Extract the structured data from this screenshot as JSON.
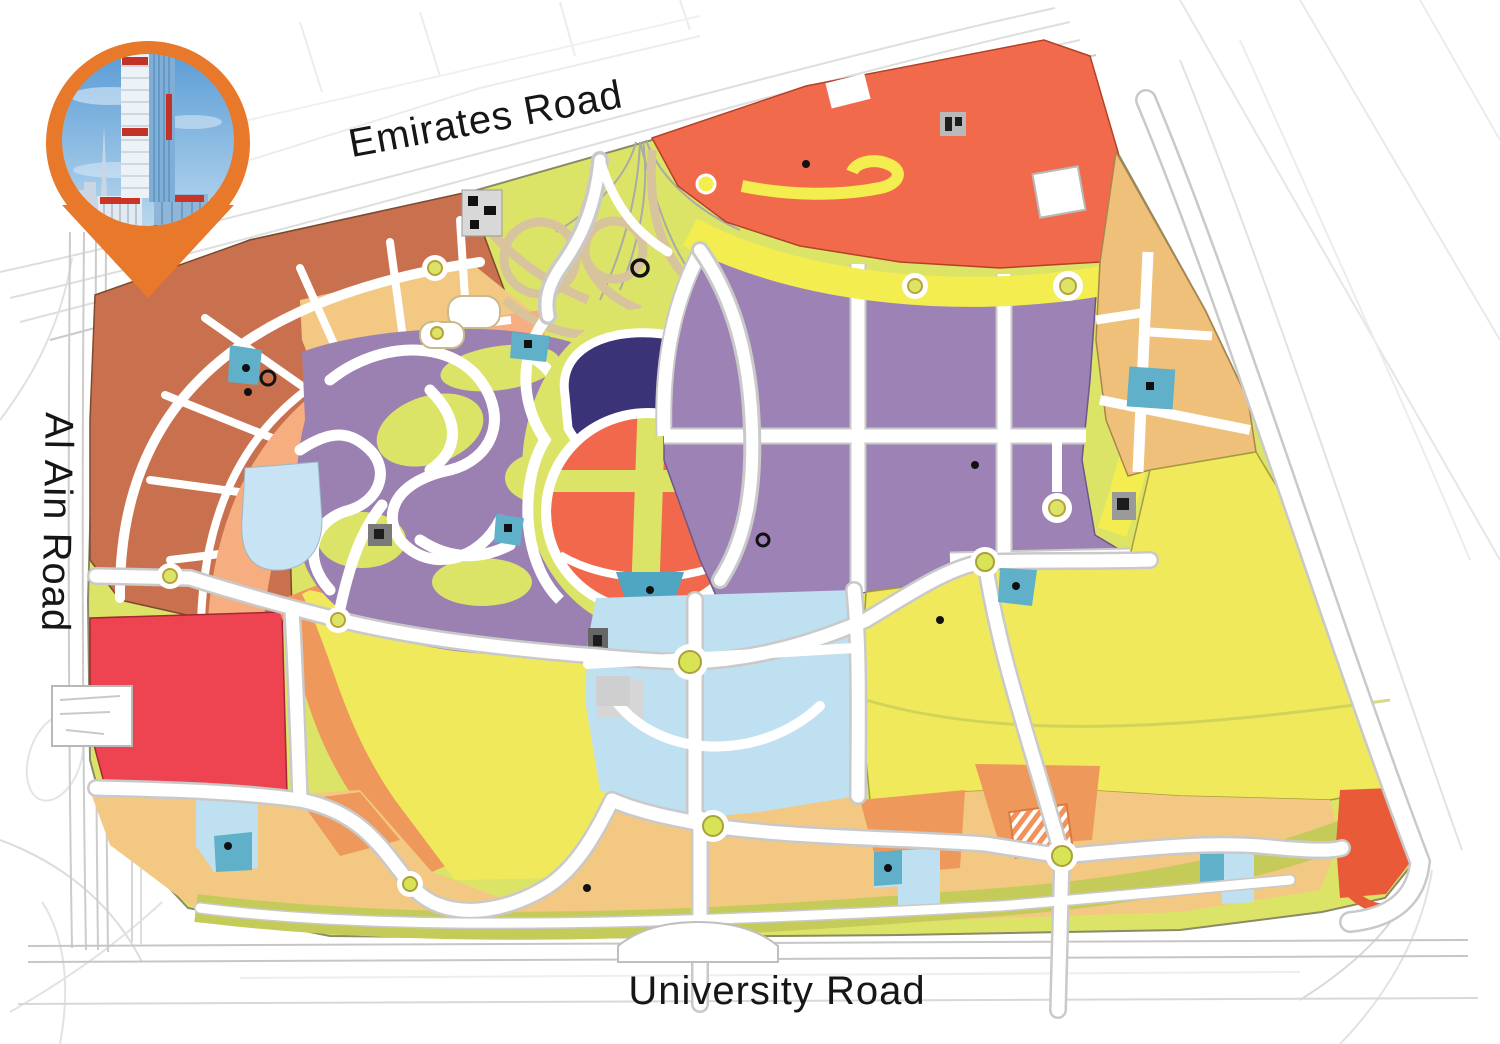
{
  "map": {
    "type": "master-plan-map",
    "labels": {
      "top_road": "Emirates Road",
      "left_road": "Al Ain Road",
      "bottom_road": "University Road"
    },
    "regions": [
      {
        "name": "terracotta-residential-northwest",
        "color": "#C9714E"
      },
      {
        "name": "salmon-residential-arc",
        "color": "#F6AD7F"
      },
      {
        "name": "tan-residential",
        "color": "#F2C883"
      },
      {
        "name": "orange-mixed-use",
        "color": "#EF985B"
      },
      {
        "name": "red-plot-west",
        "color": "#EE4350"
      },
      {
        "name": "orange-red-strip-north",
        "color": "#F26A4C"
      },
      {
        "name": "central-oval-orange",
        "color": "#F2684C"
      },
      {
        "name": "bright-yellow-band",
        "color": "#F4ED50"
      },
      {
        "name": "large-yellow-open-area",
        "color": "#F0E95C"
      },
      {
        "name": "yellow-green-park",
        "color": "#DCE468"
      },
      {
        "name": "olive-green-band",
        "color": "#C5CB58"
      },
      {
        "name": "purple-district",
        "color": "#9D82B6"
      },
      {
        "name": "navy-lake",
        "color": "#3B3377"
      },
      {
        "name": "light-blue-district",
        "color": "#BFE0F1"
      },
      {
        "name": "school-plot-blue",
        "color": "#5FB0C8"
      },
      {
        "name": "teal-plot",
        "color": "#4FA6C2"
      }
    ],
    "road_colors": {
      "surface": "#FFFFFF",
      "casing": "#C9C9C9",
      "sketch": "#DEDEDE"
    }
  },
  "pin": {
    "name": "location-pin",
    "color": "#E8782A",
    "photo": "tower-building-photo",
    "photo_sky_top": "#5D9DD6",
    "photo_sky_bottom": "#B7D7EE"
  }
}
